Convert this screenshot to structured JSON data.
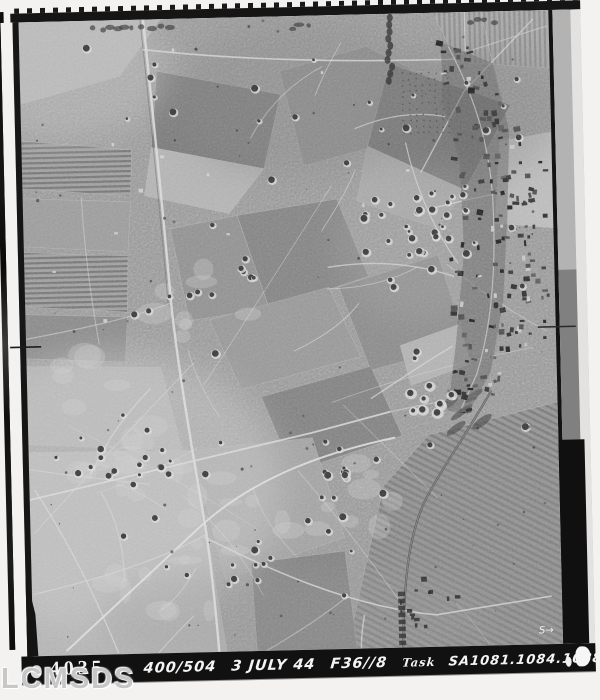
{
  "page": {
    "background_color": "#f3f2f1"
  },
  "film": {
    "border_color": "#151515",
    "edge_strip_color": "#111111"
  },
  "photo": {
    "base_color": "#9a9a9a",
    "fiducial_right_label": "S→"
  },
  "caption": {
    "strip_color": "#111111",
    "text_color": "#f4f4f4",
    "frame_number": "4035",
    "sortie": "400/504",
    "date": "3 JULY 44",
    "camera": "F36//8",
    "task_label": "Task",
    "task_numbers": "SA1081.1084.1088",
    "altitude": "29,000'"
  },
  "watermark": {
    "text": "LCMSDS",
    "color": "#c7c7c7"
  }
}
